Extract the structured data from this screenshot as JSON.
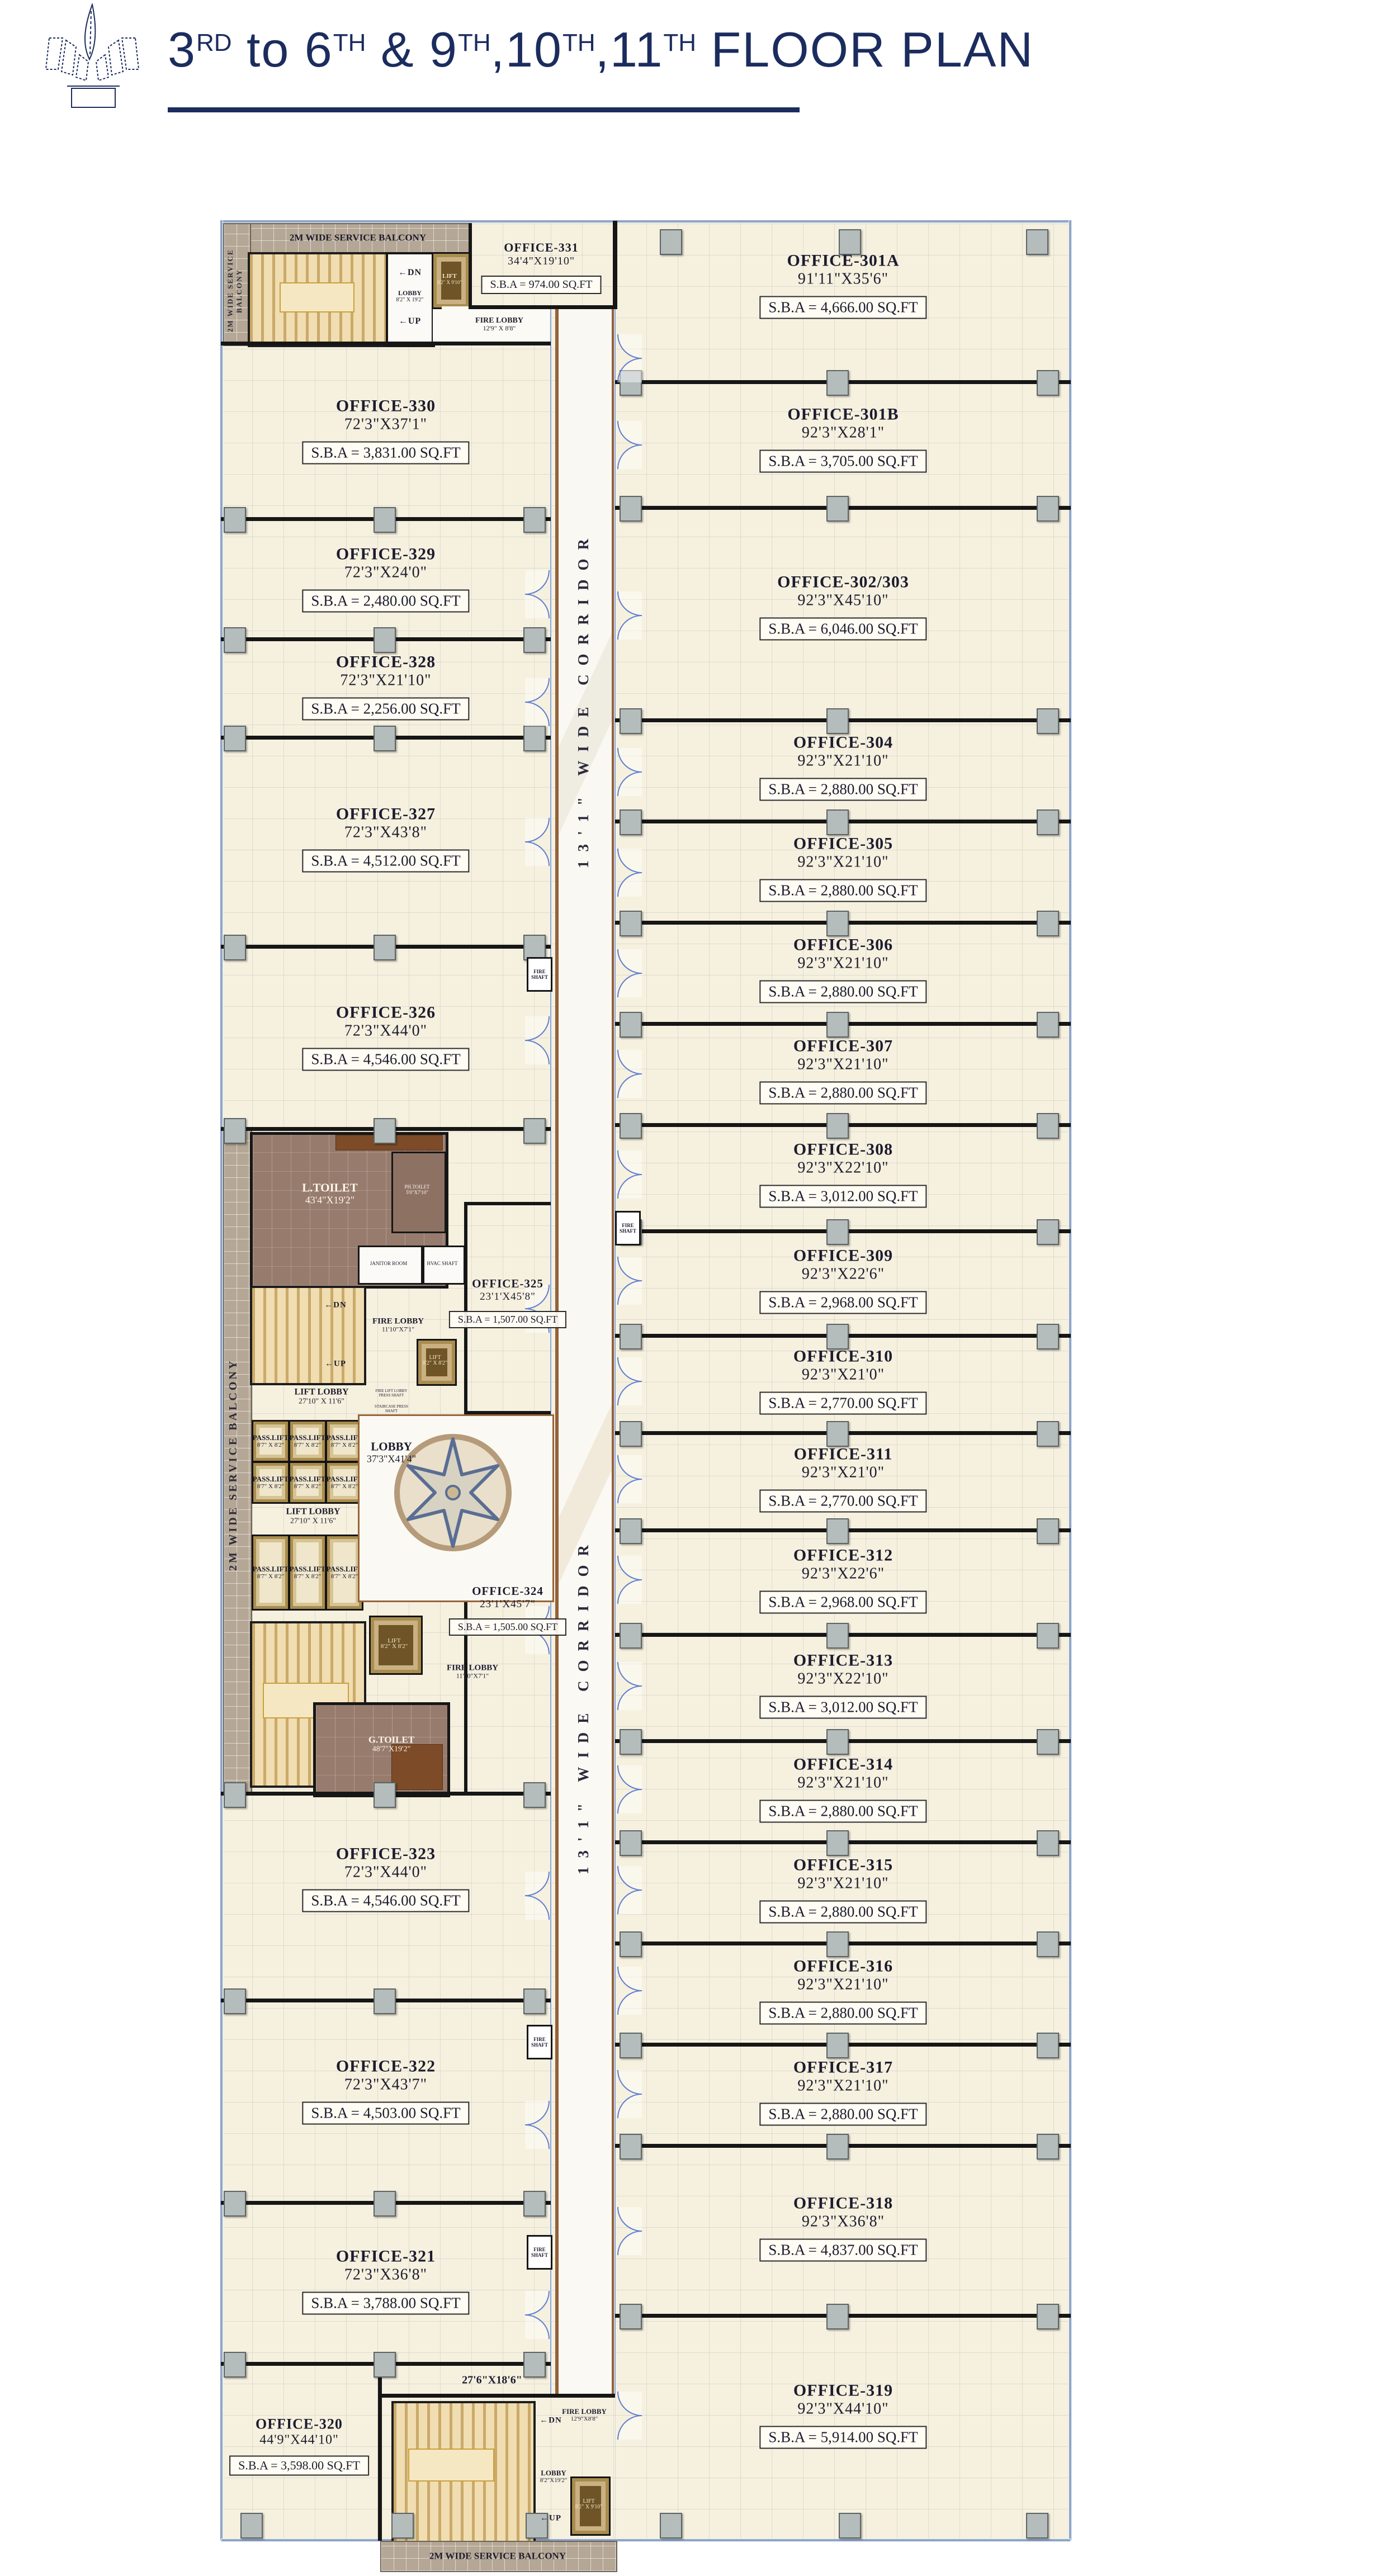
{
  "header": {
    "title": {
      "seg0": "3",
      "sup0": "RD",
      "seg1": " to 6",
      "sup1": "TH",
      "seg2": " & 9",
      "sup2": "TH",
      "seg3": ",10",
      "sup3": "TH",
      "seg4": ",11",
      "sup4": "TH",
      "seg5": " FLOOR PLAN"
    },
    "accent_color": "#1b2c5e"
  },
  "plan": {
    "corridor": {
      "label_upper": "13'1\" WIDE CORRIDOR",
      "label_lower": "13'1\" WIDE CORRIDOR",
      "junction_dim": "27'6\"X18'6\""
    },
    "balcony": {
      "label": "2M WIDE SERVICE BALCONY"
    },
    "core_top": {
      "lobby_name": "LOBBY",
      "lobby_dim": "8'2\" X 19'2\"",
      "fire_lobby_name": "FIRE LOBBY",
      "fire_lobby_dim": "12'9\" X 8'8\"",
      "lift_name": "LIFT",
      "lift_dim": "8'2\" X 9'10\"",
      "dn": "DN",
      "up": "UP"
    },
    "core_mid": {
      "l_toilet_name": "L.TOILET",
      "l_toilet_dim": "43'4\"X19'2\"",
      "ph_toilet_name": "PH.TOILET",
      "ph_toilet_dim": "5'0\"X7'10\"",
      "janitor": "JANITOR ROOM",
      "hvac": "HVAC SHAFT",
      "fire_shaft": "FIRE SHAFT",
      "fire_lobby_name": "FIRE LOBBY",
      "fire_lobby_dim": "11'10\"X7'1\"",
      "lift_name": "LIFT",
      "lift_dim": "8'2\" X 8'2\"",
      "pass_lift_name": "PASS.LIFT",
      "pass_lift_dim": "8'7\" X 8'2\"",
      "lift_lobby_name": "LIFT LOBBY",
      "lift_lobby_dim": "27'10\" X 11'6\"",
      "lobby_name": "LOBBY",
      "lobby_dim": "37'3\"X41'4\"",
      "g_toilet_name": "G.TOILET",
      "g_toilet_dim": "48'7\"X19'2\"",
      "stair_shaft": "STAIRCASE PRESS SHAFT",
      "fire_lift_shaft": "FIRE LIFT LOBBY PRESS SHAFT"
    },
    "core_bottom": {
      "lobby_name": "LOBBY",
      "lobby_dim": "8'2\"X19'2\"",
      "fire_lobby_name": "FIRE LOBBY",
      "fire_lobby_dim": "12'9\"X8'8\"",
      "lift_name": "LIFT",
      "lift_dim": "8'2\" X 9'10\"",
      "dn": "DN",
      "up": "UP"
    },
    "offices": [
      {
        "id": "office-331",
        "name": "OFFICE-331",
        "dim": "34'4\"X19'10\"",
        "sba": "S.B.A = 974.00 SQ.FT"
      },
      {
        "id": "office-330",
        "name": "OFFICE-330",
        "dim": "72'3\"X37'1\"",
        "sba": "S.B.A = 3,831.00 SQ.FT"
      },
      {
        "id": "office-329",
        "name": "OFFICE-329",
        "dim": "72'3\"X24'0\"",
        "sba": "S.B.A = 2,480.00 SQ.FT"
      },
      {
        "id": "office-328",
        "name": "OFFICE-328",
        "dim": "72'3\"X21'10\"",
        "sba": "S.B.A = 2,256.00 SQ.FT"
      },
      {
        "id": "office-327",
        "name": "OFFICE-327",
        "dim": "72'3\"X43'8\"",
        "sba": "S.B.A = 4,512.00 SQ.FT"
      },
      {
        "id": "office-326",
        "name": "OFFICE-326",
        "dim": "72'3\"X44'0\"",
        "sba": "S.B.A = 4,546.00 SQ.FT"
      },
      {
        "id": "office-325",
        "name": "OFFICE-325",
        "dim": "23'1'X45'8\"",
        "sba": "S.B.A = 1,507.00 SQ.FT"
      },
      {
        "id": "office-324",
        "name": "OFFICE-324",
        "dim": "23'1'X45'7\"",
        "sba": "S.B.A = 1,505.00 SQ.FT"
      },
      {
        "id": "office-323",
        "name": "OFFICE-323",
        "dim": "72'3\"X44'0\"",
        "sba": "S.B.A = 4,546.00 SQ.FT"
      },
      {
        "id": "office-322",
        "name": "OFFICE-322",
        "dim": "72'3\"X43'7\"",
        "sba": "S.B.A = 4,503.00 SQ.FT"
      },
      {
        "id": "office-321",
        "name": "OFFICE-321",
        "dim": "72'3\"X36'8\"",
        "sba": "S.B.A = 3,788.00 SQ.FT"
      },
      {
        "id": "office-320",
        "name": "OFFICE-320",
        "dim": "44'9\"X44'10\"",
        "sba": "S.B.A = 3,598.00 SQ.FT"
      },
      {
        "id": "office-301a",
        "name": "OFFICE-301A",
        "dim": "91'11\"X35'6\"",
        "sba": "S.B.A = 4,666.00 SQ.FT"
      },
      {
        "id": "office-301b",
        "name": "OFFICE-301B",
        "dim": "92'3\"X28'1\"",
        "sba": "S.B.A = 3,705.00 SQ.FT"
      },
      {
        "id": "office-302-303",
        "name": "OFFICE-302/303",
        "dim": "92'3\"X45'10\"",
        "sba": "S.B.A = 6,046.00 SQ.FT"
      },
      {
        "id": "office-304",
        "name": "OFFICE-304",
        "dim": "92'3\"X21'10\"",
        "sba": "S.B.A = 2,880.00 SQ.FT"
      },
      {
        "id": "office-305",
        "name": "OFFICE-305",
        "dim": "92'3\"X21'10\"",
        "sba": "S.B.A = 2,880.00 SQ.FT"
      },
      {
        "id": "office-306",
        "name": "OFFICE-306",
        "dim": "92'3\"X21'10\"",
        "sba": "S.B.A = 2,880.00 SQ.FT"
      },
      {
        "id": "office-307",
        "name": "OFFICE-307",
        "dim": "92'3\"X21'10\"",
        "sba": "S.B.A = 2,880.00 SQ.FT"
      },
      {
        "id": "office-308",
        "name": "OFFICE-308",
        "dim": "92'3\"X22'10\"",
        "sba": "S.B.A = 3,012.00 SQ.FT"
      },
      {
        "id": "office-309",
        "name": "OFFICE-309",
        "dim": "92'3\"X22'6\"",
        "sba": "S.B.A = 2,968.00 SQ.FT"
      },
      {
        "id": "office-310",
        "name": "OFFICE-310",
        "dim": "92'3\"X21'0\"",
        "sba": "S.B.A = 2,770.00 SQ.FT"
      },
      {
        "id": "office-311",
        "name": "OFFICE-311",
        "dim": "92'3\"X21'0\"",
        "sba": "S.B.A = 2,770.00 SQ.FT"
      },
      {
        "id": "office-312",
        "name": "OFFICE-312",
        "dim": "92'3\"X22'6\"",
        "sba": "S.B.A = 2,968.00 SQ.FT"
      },
      {
        "id": "office-313",
        "name": "OFFICE-313",
        "dim": "92'3\"X22'10\"",
        "sba": "S.B.A = 3,012.00 SQ.FT"
      },
      {
        "id": "office-314",
        "name": "OFFICE-314",
        "dim": "92'3\"X21'10\"",
        "sba": "S.B.A = 2,880.00 SQ.FT"
      },
      {
        "id": "office-315",
        "name": "OFFICE-315",
        "dim": "92'3\"X21'10\"",
        "sba": "S.B.A = 2,880.00 SQ.FT"
      },
      {
        "id": "office-316",
        "name": "OFFICE-316",
        "dim": "92'3\"X21'10\"",
        "sba": "S.B.A = 2,880.00 SQ.FT"
      },
      {
        "id": "office-317",
        "name": "OFFICE-317",
        "dim": "92'3\"X21'10\"",
        "sba": "S.B.A = 2,880.00 SQ.FT"
      },
      {
        "id": "office-318",
        "name": "OFFICE-318",
        "dim": "92'3\"X36'8\"",
        "sba": "S.B.A = 4,837.00 SQ.FT"
      },
      {
        "id": "office-319",
        "name": "OFFICE-319",
        "dim": "92'3\"X44'10\"",
        "sba": "S.B.A = 5,914.00 SQ.FT"
      }
    ]
  }
}
